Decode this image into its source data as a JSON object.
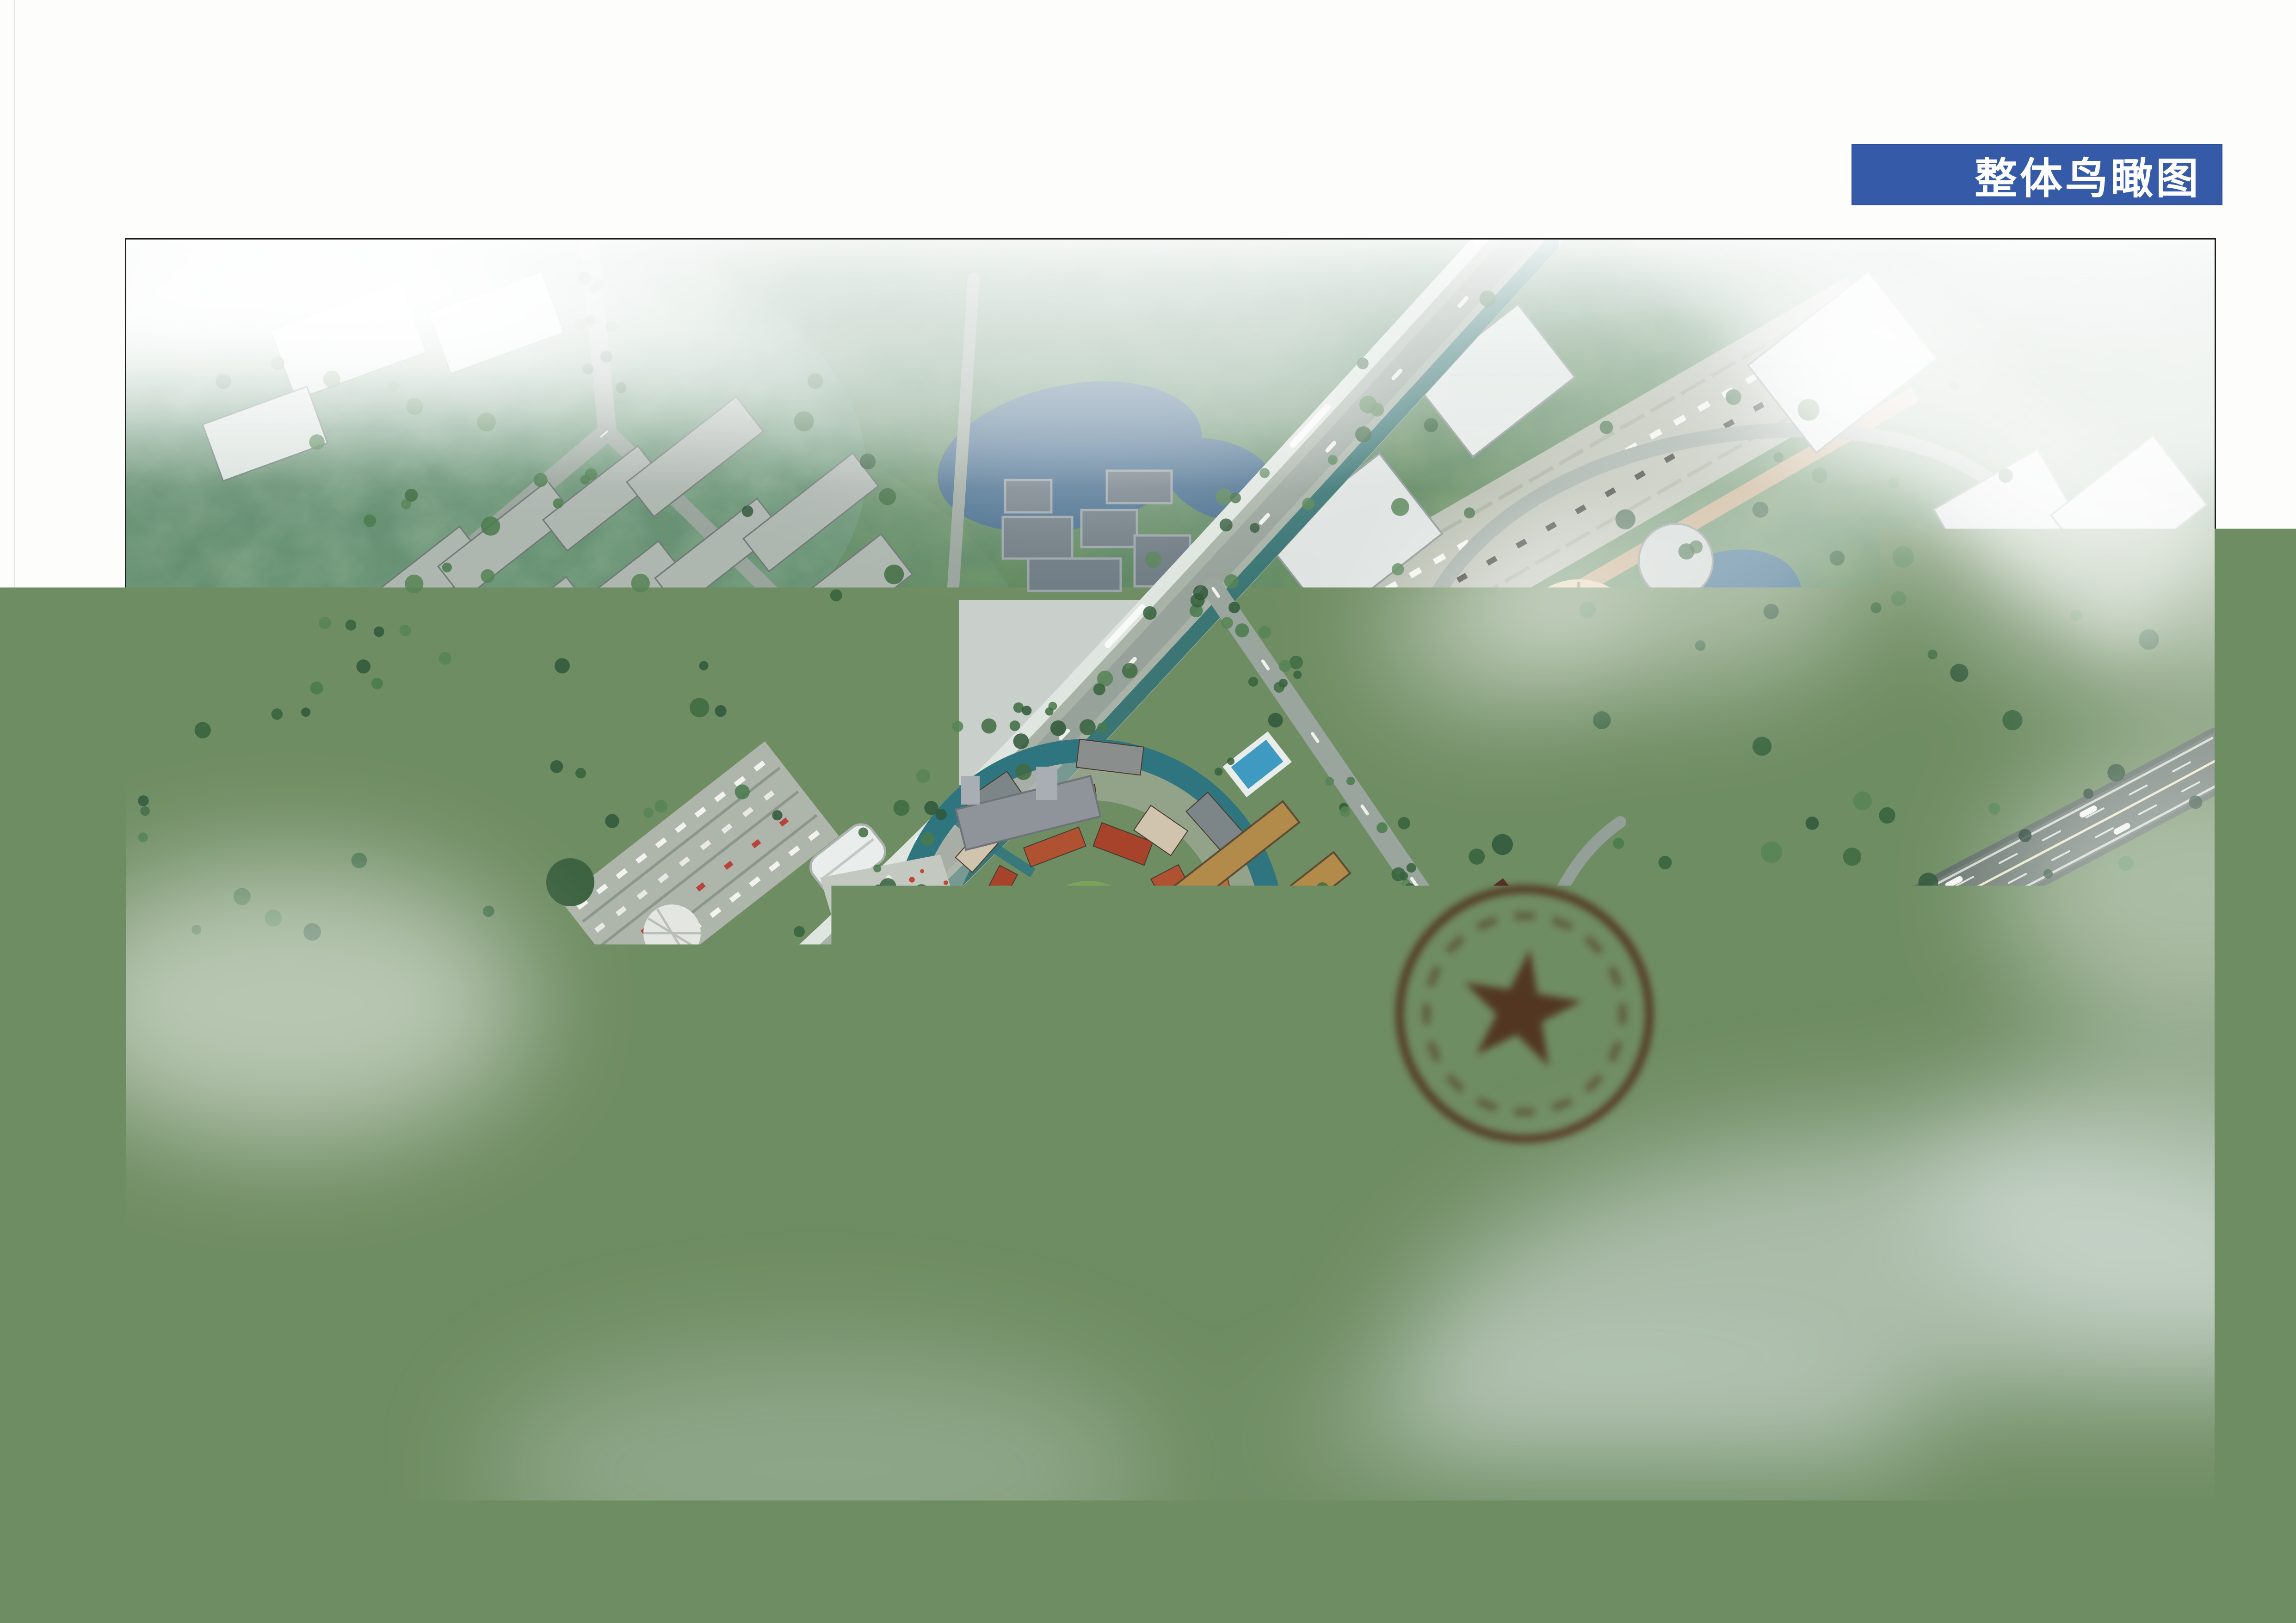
{
  "banner": {
    "label": "整体鸟瞰图",
    "bg_color": "#355ba8",
    "text_color": "#ffffff"
  },
  "caption": {
    "text": "芜湖市城东6号地块规划设计方案",
    "color": "#3a3a3a"
  },
  "rendering": {
    "seal_icon": "official-red-seal-icon",
    "seal_color": "#a93526",
    "water_color": "#2f7580",
    "town_roof_color": "#b05231",
    "villa_roof_color": "#46403a",
    "villa_facade_color": "#c89c56",
    "road_color": "#98a39c",
    "highway_color": "#5e6b64",
    "rail_color": "#f3f6f2"
  }
}
